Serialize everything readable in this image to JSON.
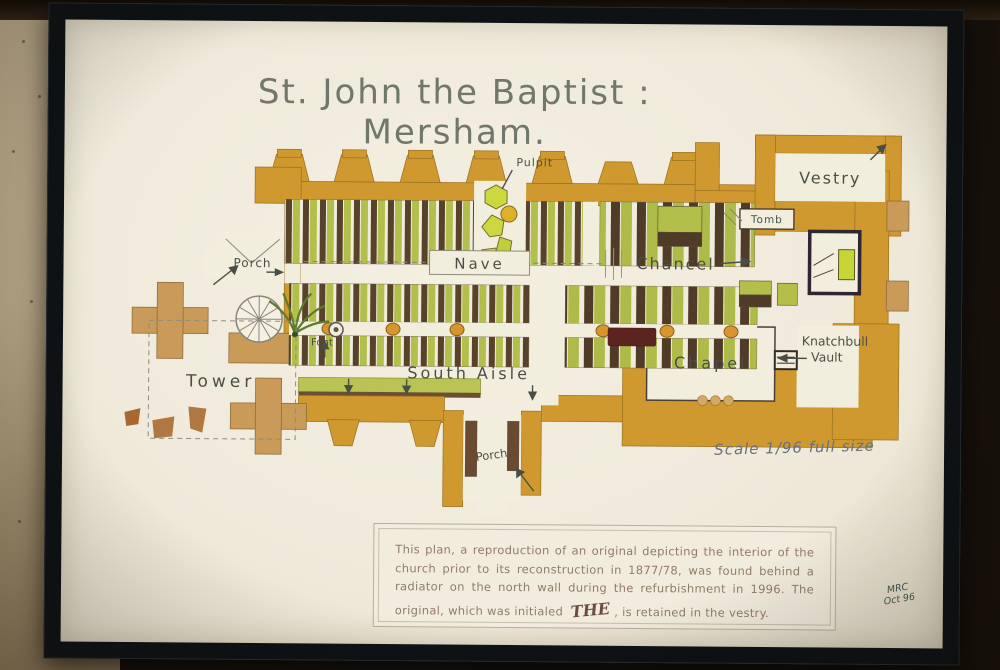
{
  "photo": {
    "title": "St. John the Baptist : Mersham.",
    "scale_note": "Scale 1/96 full size",
    "signature_line1": "MRC",
    "signature_line2": "Oct 96"
  },
  "plan_labels": {
    "pulpit": "Pulpit",
    "vestry": "Vestry",
    "tomb": "Tomb",
    "porch_north": "Porch",
    "nave": "Nave",
    "chancel": "Chancel",
    "chapel": "Chapel",
    "knatchbull_line1": "Knatchbull",
    "knatchbull_line2": "Vault",
    "tower": "Tower",
    "font": "Font",
    "south_aisle": "South Aisle",
    "porch_south": "Porch"
  },
  "caption": {
    "text_before_initials": "This plan, a reproduction of an original depicting the interior of the church prior to its reconstruction in 1877/78, was found behind a radiator on the north wall during the refurbishment in 1996. The original, which was initialed",
    "initials": "THE",
    "text_after_initials": ", is retained in the vestry."
  },
  "colors": {
    "wall_ochre": "#d0992f",
    "buttress_tan": "#c99a58",
    "pew_brown": "#55402a",
    "pew_green": "#b2bf4b",
    "paper": "#efeadb",
    "frame": "#0e1215",
    "room_wall": "#b2a283"
  }
}
